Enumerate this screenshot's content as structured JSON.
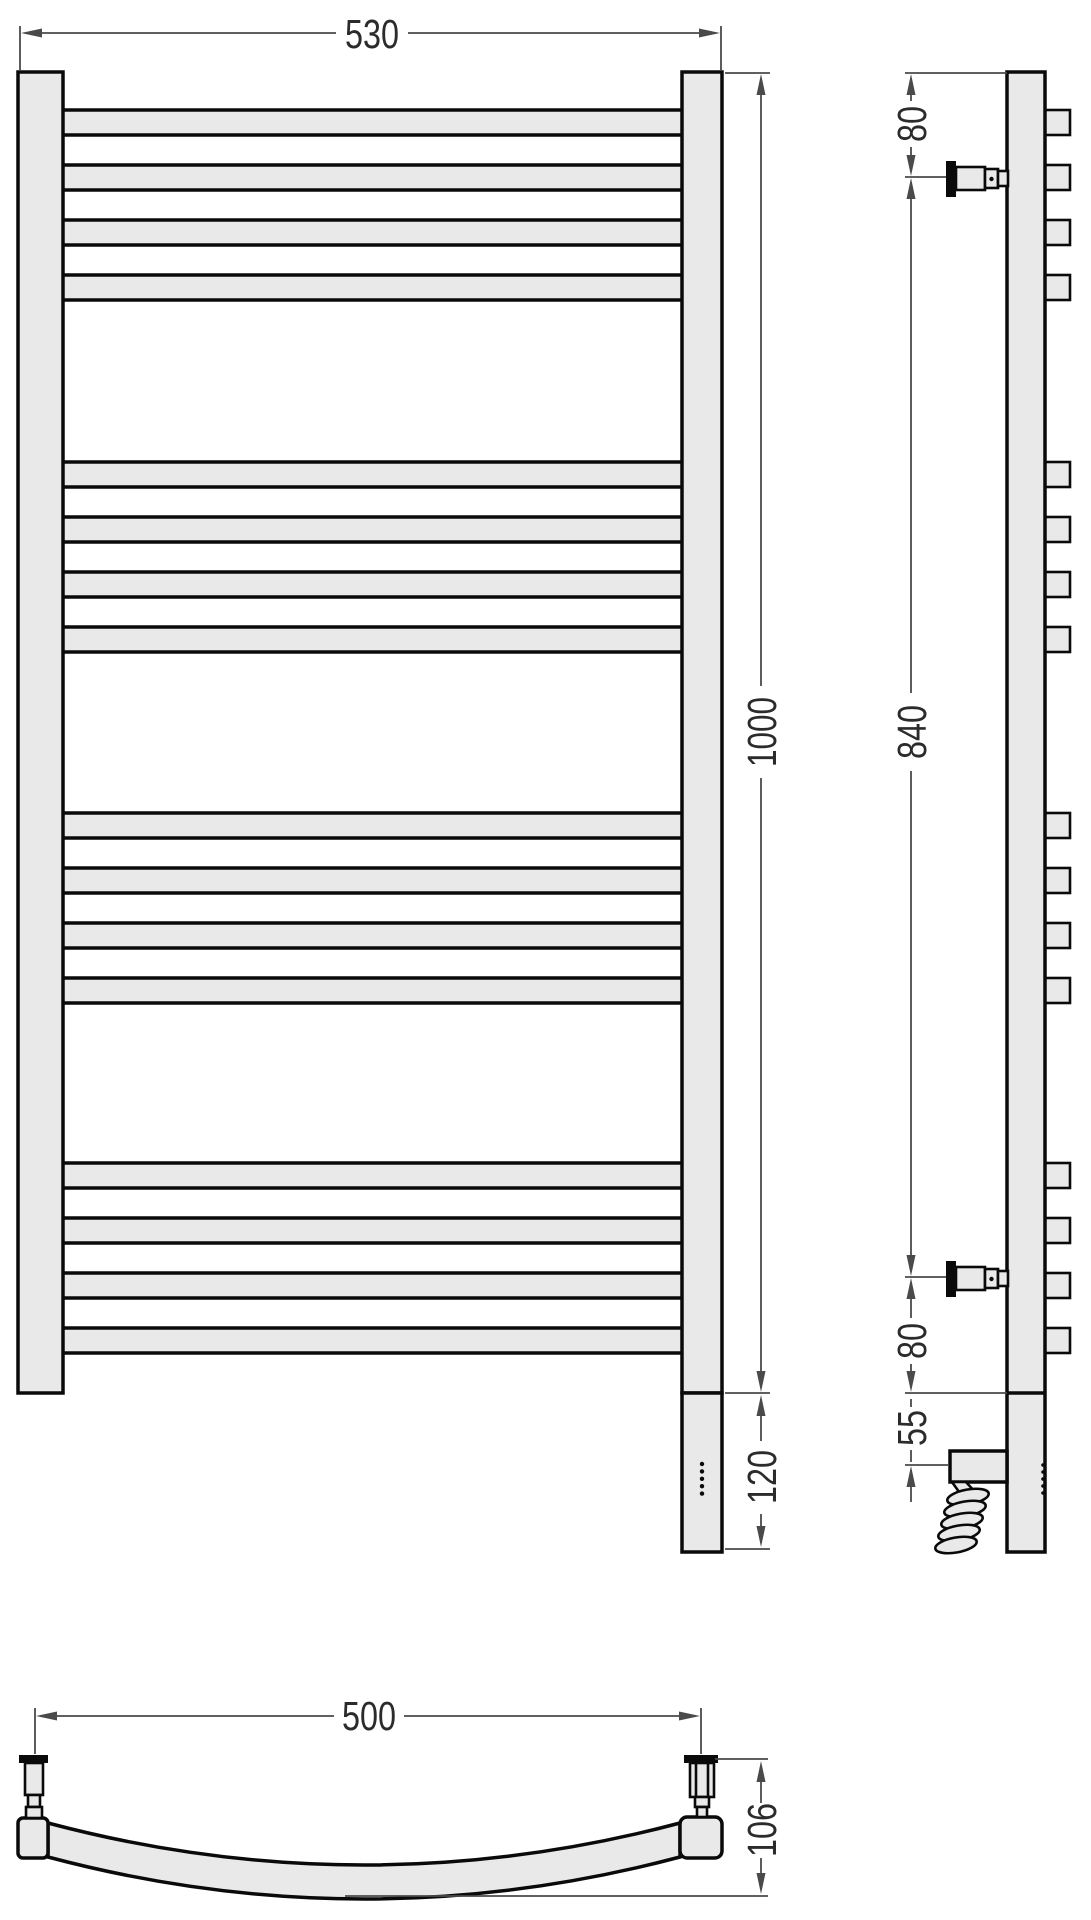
{
  "drawing": {
    "kind": "technical-drawing",
    "subject": "ladder towel rail with electric heating element, front / side / bottom views",
    "colors": {
      "fill": "#e9e9e9",
      "outline": "#0a0a0a",
      "dim_line": "#4a4a4a",
      "text": "#2b2b2b"
    }
  },
  "front_view": {
    "dims": {
      "overall_width_mm": "530",
      "overall_height_mm": "1000",
      "heater_section_mm": "120"
    },
    "rung_tops": [
      110,
      165,
      220,
      275,
      462,
      517,
      572,
      627,
      813,
      868,
      923,
      978,
      1163,
      1218,
      1273,
      1328
    ],
    "rung_height": 25,
    "indicator_dot_count": 5
  },
  "side_view": {
    "dims": {
      "top_to_bracket_mm": "80",
      "bracket_span_mm": "840",
      "bracket_to_bottom_mm": "80",
      "bottom_to_heater_mm": "55"
    }
  },
  "bottom_view": {
    "dims": {
      "mount_spacing_mm": "500",
      "depth_mm": "106"
    }
  }
}
